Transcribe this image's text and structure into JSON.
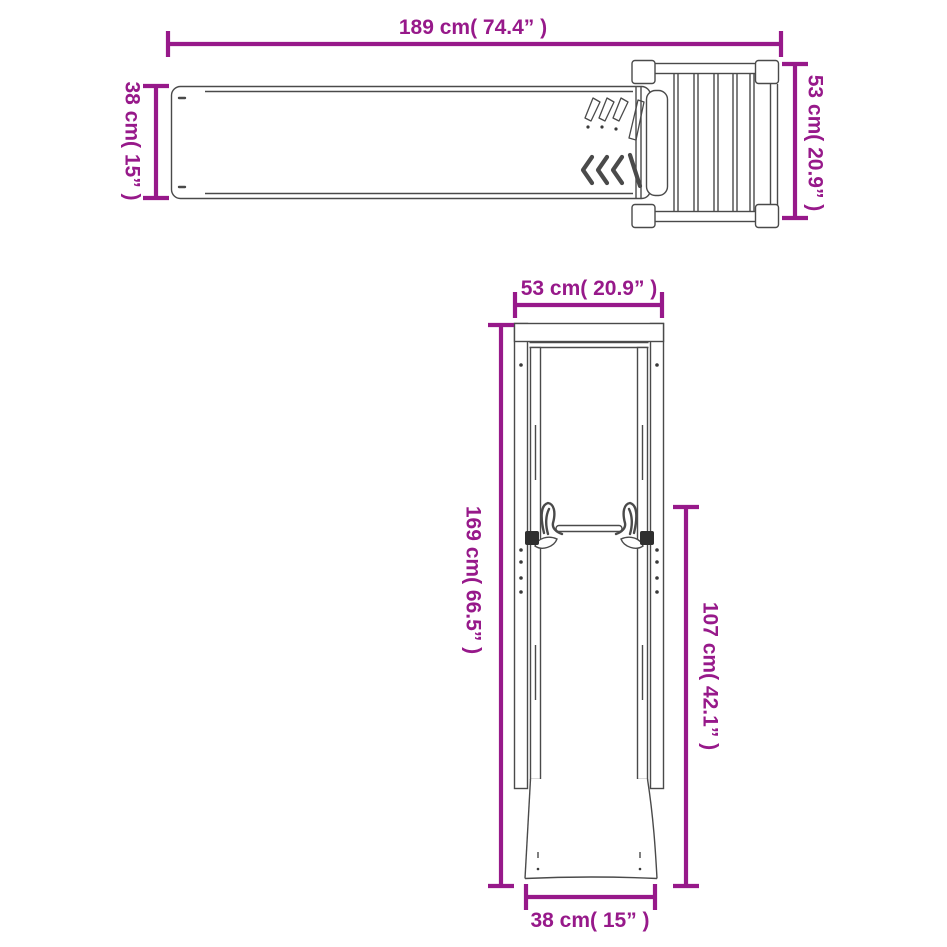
{
  "colors": {
    "accent": "#97198A",
    "line_art": "#4A4A4A",
    "background": "#FFFFFF"
  },
  "top_view": {
    "length": "189 cm( 74.4” )",
    "width": "38 cm( 15” )",
    "platform_depth": "53 cm( 20.9” )"
  },
  "front_view": {
    "frame_width": "53 cm( 20.9” )",
    "total_height": "169 cm( 66.5” )",
    "slide_height": "107 cm( 42.1” )",
    "base_width": "38 cm( 15” )"
  }
}
